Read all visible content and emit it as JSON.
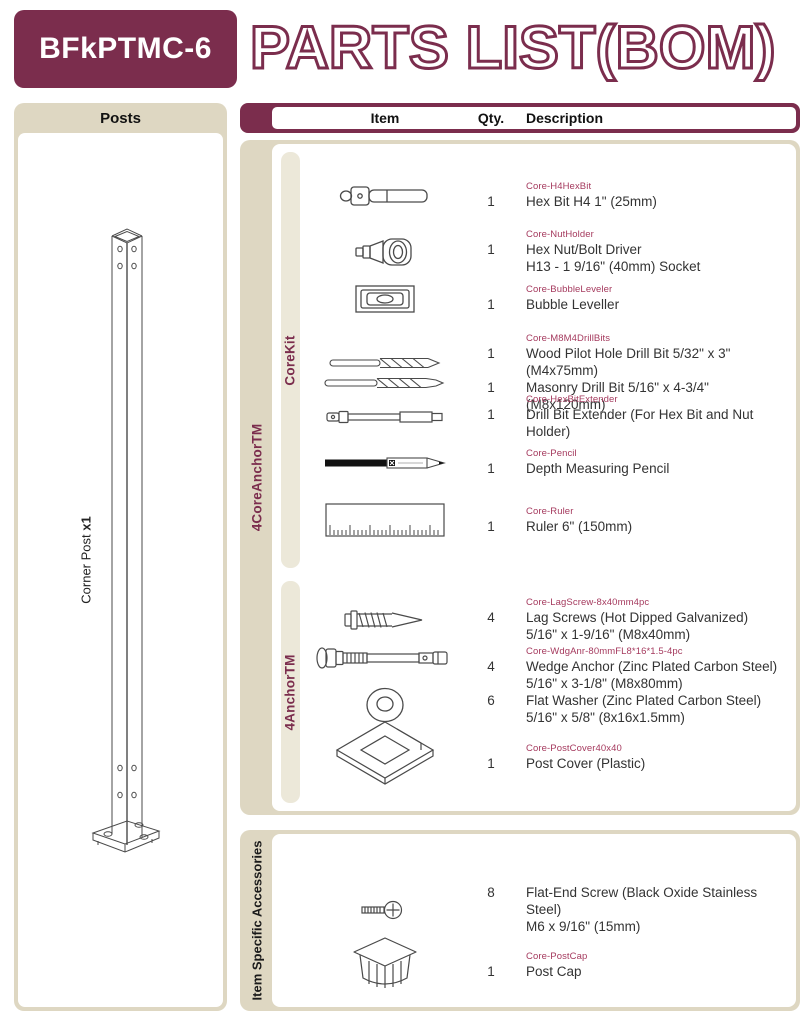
{
  "header": {
    "product_code": "BFkPTMC-6",
    "title_outline": "PARTS LIST",
    "title_suffix": "(BOM)"
  },
  "colors": {
    "maroon": "#7b2d4d",
    "part_number_red": "#a53a5e",
    "panel_beige": "#ded7c2",
    "strip_beige": "#ece8d9"
  },
  "posts_panel": {
    "title": "Posts",
    "post_label": "Corner Post",
    "post_qty_label": "x1",
    "post_illustration": "corner-post-drawing"
  },
  "table_header": {
    "item": "Item",
    "qty": "Qty.",
    "description": "Description"
  },
  "sections": [
    {
      "label": "4CoreAnchorTM",
      "subsections": [
        {
          "label": "CoreKit",
          "items": [
            {
              "part_number": "Core-H4HexBit",
              "icons": [
                "hex-bit-icon"
              ],
              "entries": [
                {
                  "qty": "1",
                  "lines": [
                    "Hex Bit H4 1\" (25mm)"
                  ]
                }
              ]
            },
            {
              "part_number": "Core-NutHolder",
              "icons": [
                "nut-driver-icon"
              ],
              "entries": [
                {
                  "qty": "1",
                  "lines": [
                    "Hex Nut/Bolt Driver",
                    "H13 - 1 9/16\" (40mm) Socket"
                  ]
                }
              ]
            },
            {
              "part_number": "Core-BubbleLeveler",
              "icons": [
                "bubble-level-icon"
              ],
              "entries": [
                {
                  "qty": "1",
                  "lines": [
                    "Bubble Leveller"
                  ]
                }
              ]
            },
            {
              "part_number": "Core-M8M4DrillBits",
              "icons": [
                "wood-drill-bit-icon",
                "masonry-drill-bit-icon"
              ],
              "entries": [
                {
                  "qty": "1",
                  "lines": [
                    "Wood Pilot Hole Drill Bit 5/32\" x 3\" (M4x75mm)"
                  ]
                },
                {
                  "qty": "1",
                  "lines": [
                    "Masonry Drill Bit 5/16\" x 4-3/4\" (M8x120mm)"
                  ]
                }
              ]
            },
            {
              "part_number": "Core-HexBitExtender",
              "icons": [
                "drill-bit-extender-icon"
              ],
              "entries": [
                {
                  "qty": "1",
                  "lines": [
                    "Drill Bit Extender (For Hex Bit and Nut Holder)"
                  ]
                }
              ]
            },
            {
              "part_number": "Core-Pencil",
              "icons": [
                "pencil-icon"
              ],
              "entries": [
                {
                  "qty": "1",
                  "lines": [
                    "Depth Measuring Pencil"
                  ]
                }
              ]
            },
            {
              "part_number": "Core-Ruler",
              "icons": [
                "ruler-icon"
              ],
              "entries": [
                {
                  "qty": "1",
                  "lines": [
                    "Ruler 6\" (150mm)"
                  ]
                }
              ]
            }
          ]
        },
        {
          "label": "4AnchorTM",
          "items": [
            {
              "part_number": "Core-LagScrew-8x40mm4pc",
              "icons": [
                "lag-screw-icon"
              ],
              "entries": [
                {
                  "qty": "4",
                  "lines": [
                    "Lag Screws (Hot Dipped Galvanized)",
                    "5/16\" x 1-9/16\" (M8x40mm)"
                  ]
                }
              ]
            },
            {
              "part_number": "Core-WdgAnr-80mmFL8*16*1.5-4pc",
              "icons": [
                "wedge-anchor-icon",
                "flat-washer-icon"
              ],
              "entries": [
                {
                  "qty": "4",
                  "lines": [
                    "Wedge Anchor (Zinc Plated Carbon Steel)",
                    "5/16\" x 3-1/8\" (M8x80mm)"
                  ]
                },
                {
                  "qty": "6",
                  "lines": [
                    "Flat Washer (Zinc Plated Carbon Steel)",
                    "5/16\" x 5/8\" (8x16x1.5mm)"
                  ]
                }
              ]
            },
            {
              "part_number": "Core-PostCover40x40",
              "icons": [
                "post-cover-icon"
              ],
              "entries": [
                {
                  "qty": "1",
                  "lines": [
                    "Post Cover (Plastic)"
                  ]
                }
              ]
            }
          ]
        }
      ]
    },
    {
      "label": "Item Specific Accessories",
      "subsections": [
        {
          "label": null,
          "items": [
            {
              "part_number": null,
              "icons": [
                "flat-end-screw-icon"
              ],
              "entries": [
                {
                  "qty": "8",
                  "lines": [
                    "Flat-End Screw (Black Oxide Stainless Steel)",
                    "M6 x 9/16\" (15mm)"
                  ]
                }
              ]
            },
            {
              "part_number": "Core-PostCap",
              "icons": [
                "post-cap-icon"
              ],
              "entries": [
                {
                  "qty": "1",
                  "lines": [
                    "Post Cap"
                  ]
                }
              ]
            }
          ]
        }
      ]
    }
  ]
}
